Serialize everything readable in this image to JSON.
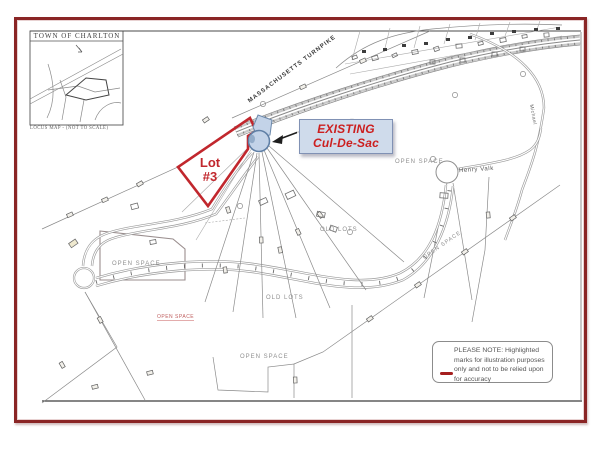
{
  "colors": {
    "page_border": "#8a2525",
    "highlight_red": "#c1272d",
    "callout_text": "#cc1f1f",
    "callout_bg": "#cfdbeb",
    "culdesac_fill": "#c3d3e8",
    "culdesac_stroke": "#5f7fa5",
    "note_swatch": "#a51f1f"
  },
  "locus_inset": {
    "title": "TOWN OF CHARLTON",
    "caption": "LOCUS MAP  -  (NOT TO SCALE)"
  },
  "labels": {
    "turnpike": "MASSACHUSETTS TURNPIKE",
    "henry_valk": "Henry Valk",
    "michael": "Michael",
    "open_space": "OPEN SPACE",
    "old_lots": "OLD LOTS"
  },
  "highlight": {
    "lot_line1": "Lot",
    "lot_line2": "#3"
  },
  "callout": {
    "line1": "EXISTING",
    "line2": "Cul-De-Sac"
  },
  "note_box": {
    "lines": [
      "PLEASE NOTE: Highlighted",
      "marks for illustration purposes",
      "only and not to be relied upon",
      "for accuracy"
    ]
  }
}
